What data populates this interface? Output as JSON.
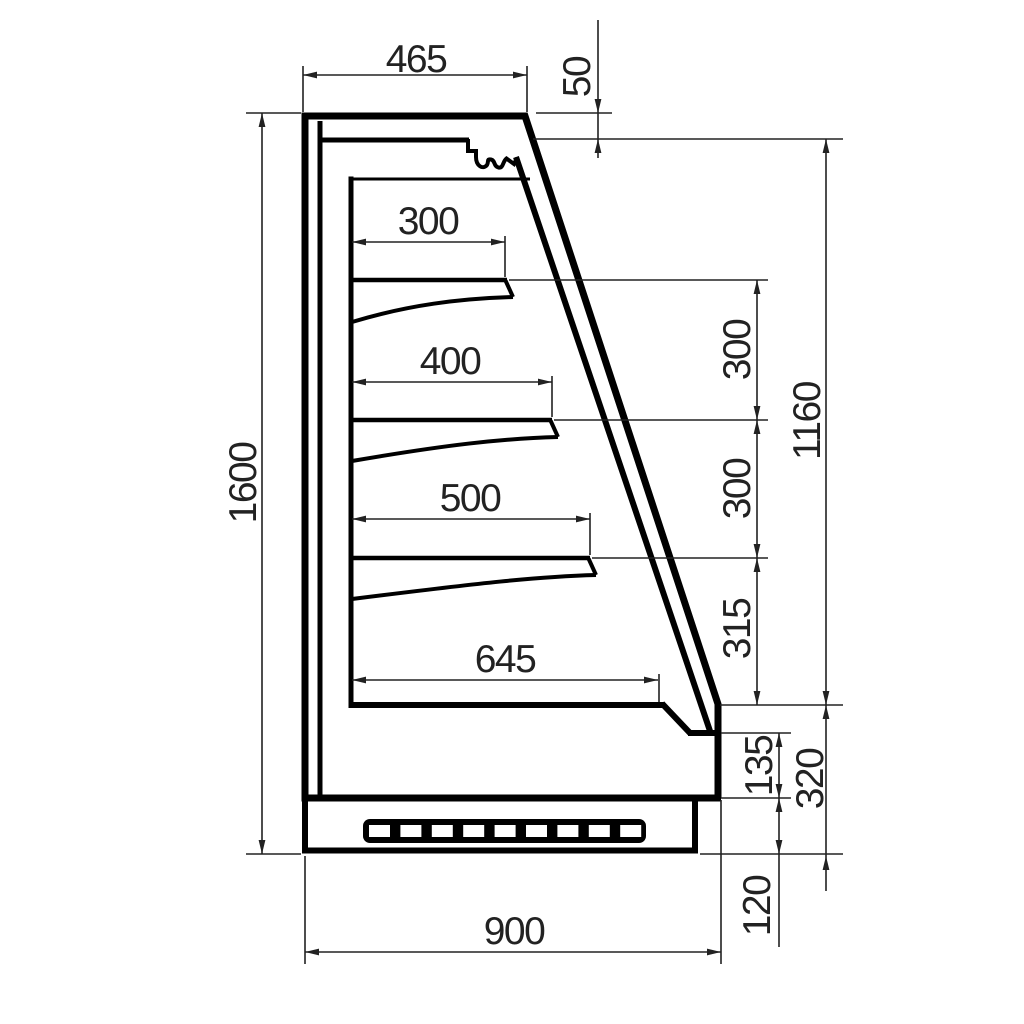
{
  "drawing": {
    "kind": "technical cross-section, refrigerated wall display case, dimensioned",
    "units_implied": "mm"
  },
  "dims": {
    "top_depth": "465",
    "canopy_gap": "50",
    "total_height": "1600",
    "shelf1_depth": "300",
    "shelf2_depth": "400",
    "shelf3_depth": "500",
    "deck_depth": "645",
    "gap_shelf1": "300",
    "gap_shelf2": "300",
    "gap_shelf3": "315",
    "opening_height": "1160",
    "return_height": "135",
    "lower_height": "320",
    "plinth_height": "120",
    "total_depth": "900"
  },
  "grille": {
    "slot_count": 9
  },
  "colors": {
    "outline": "#000000",
    "dimension": "#222222",
    "background": "#ffffff"
  }
}
